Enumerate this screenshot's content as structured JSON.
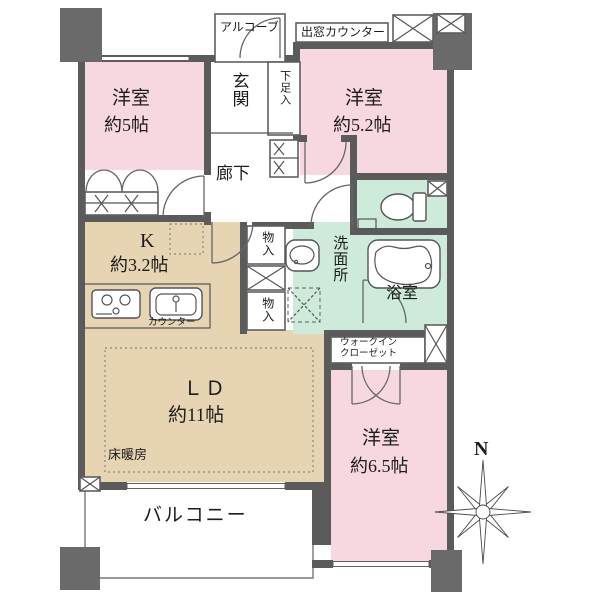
{
  "document_type": "floor-plan",
  "rooms": {
    "western_room_1": {
      "name": "洋室",
      "size": "約5帖"
    },
    "western_room_2": {
      "name": "洋室",
      "size": "約5.2帖"
    },
    "western_room_3": {
      "name": "洋室",
      "size": "約6.5帖"
    },
    "living_dining": {
      "name": "ＬＤ",
      "size": "約11帖"
    },
    "kitchen": {
      "name": "K",
      "size": "約3.2帖"
    }
  },
  "labels": {
    "entrance": "玄関",
    "corridor": "廊下",
    "alcove": "アルコーブ",
    "bay_window_counter": "出窓カウンター",
    "shoe_cabinet": "下足入",
    "storage_top": "物入",
    "storage_bottom": "物入",
    "washroom": "洗面所",
    "bathroom": "浴室",
    "wic_line1": "ウォークイン",
    "wic_line2": "クローゼット",
    "floor_heating": "床暖房",
    "balcony": "バルコニー",
    "counter": "カウンター"
  },
  "compass": {
    "north": "N"
  },
  "colors": {
    "room_pink": "#f8d8e0",
    "room_beige": "#e6d4b2",
    "room_green": "#cdeada",
    "wall_gray": "#5b5b5b",
    "pillar_gray": "#6a6a6a",
    "text": "#1c1c1c",
    "background": "#ffffff"
  }
}
